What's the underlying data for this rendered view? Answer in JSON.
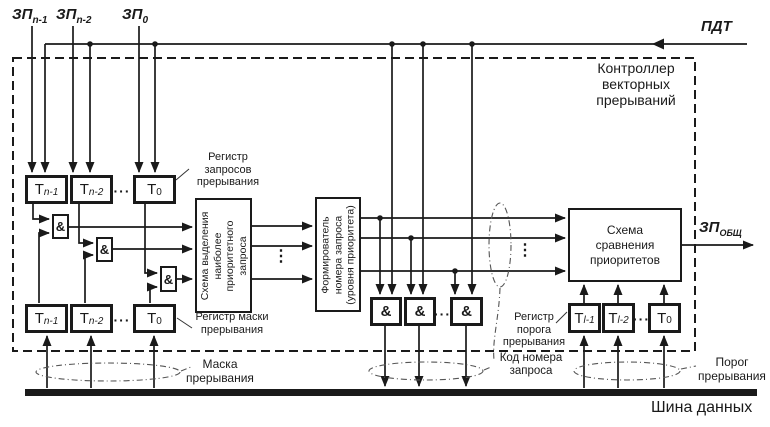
{
  "title": "Контроллер векторных прерываний",
  "signals": {
    "zp_n1": {
      "main": "ЗП",
      "sub": "n-1"
    },
    "zp_n2": {
      "main": "ЗП",
      "sub": "n-2"
    },
    "zp_0": {
      "main": "ЗП",
      "sub": "0"
    },
    "pdt": "ПДТ",
    "zp_total": {
      "main": "ЗП",
      "sub": "ОБЩ"
    }
  },
  "registers": {
    "request": {
      "label": "Регистр запросов прерывания",
      "cells": [
        {
          "main": "T",
          "sub": "n-1"
        },
        {
          "main": "T",
          "sub": "n-2"
        },
        {
          "main": "T",
          "sub": "0"
        }
      ]
    },
    "mask": {
      "label": "Регистр маски прерывания",
      "cells": [
        {
          "main": "T",
          "sub": "n-1"
        },
        {
          "main": "T",
          "sub": "n-2"
        },
        {
          "main": "T",
          "sub": "0"
        }
      ]
    },
    "threshold": {
      "label": "Регистр порога прерывания",
      "cells": [
        {
          "main": "T",
          "sub": "l-1"
        },
        {
          "main": "T",
          "sub": "l-2"
        },
        {
          "main": "T",
          "sub": "0"
        }
      ]
    }
  },
  "blocks": {
    "priority_select": "Схема выделения наиболее приоритетного запроса",
    "number_former": "Формирователь номера запроса (уровня приоритета)",
    "comparator": "Схема сравнения приоритетов"
  },
  "bus": {
    "label": "Шина данных",
    "mask_group": "Маска прерывания",
    "code_group": "Код номера запроса",
    "threshold_group": "Порог прерывания"
  },
  "symbols": {
    "and": "&",
    "hdots": "···",
    "vdots": "⋮"
  },
  "colors": {
    "line": "#1a1a1a",
    "background": "#ffffff"
  }
}
